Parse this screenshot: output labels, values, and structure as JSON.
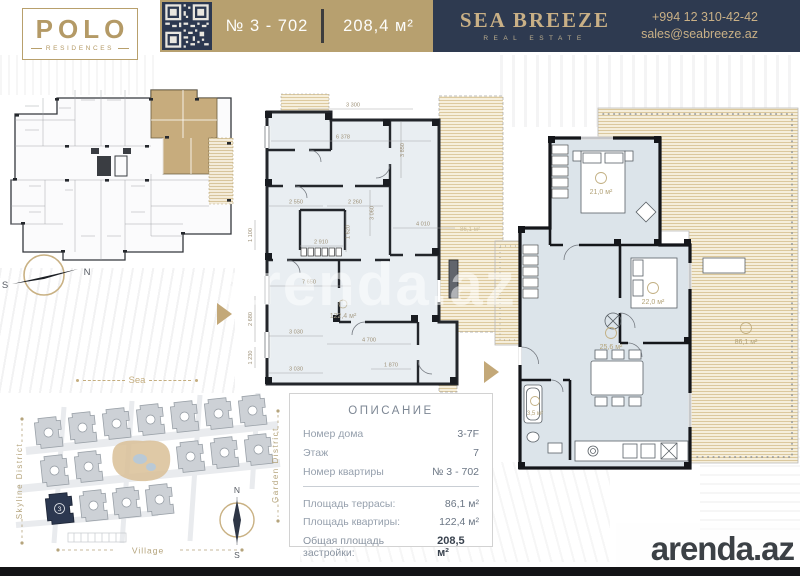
{
  "header": {
    "logo": {
      "title": "POLO",
      "subtitle": "RESIDENCES"
    },
    "apartment_number": "№ 3 - 702",
    "apartment_area": "208,4 м²",
    "agency": {
      "name": "SEA BREEZE",
      "tagline": "REAL ESTATE",
      "phone": "+994 12 310-42-42",
      "email": "sales@seabreeze.az"
    }
  },
  "colors": {
    "gold": "#b7a06f",
    "navy": "#2e3a50",
    "highlight_unit": "#c1a470",
    "plan_floor": "#dce4ea",
    "terrace": "#f5eedc"
  },
  "key_plan": {
    "compass": {
      "north": "N",
      "south": "S"
    },
    "sea_label": "Sea"
  },
  "middle_plan": {
    "dims": [
      "3 300",
      "6 378",
      "3 850",
      "2 550",
      "2 260",
      "3 060",
      "4 010",
      "1 620",
      "2 910",
      "1 100",
      "7 650",
      "2 680",
      "1 230",
      "3 030",
      "4 700",
      "3 030",
      "1 870"
    ],
    "apartment_area": "122,4 м²",
    "terrace_area": "86,1 м²"
  },
  "furnished_plan": {
    "rooms": [
      {
        "area": "21,0 м²"
      },
      {
        "area": "22,0 м²"
      },
      {
        "area": "25,6 м²"
      },
      {
        "area": "3,5 м²"
      },
      {
        "area": "86,1 м²"
      }
    ]
  },
  "site_map": {
    "district_left": "Skyline District",
    "district_right": "Garden District",
    "village_label": "Village",
    "highlighted_building": "3",
    "compass": {
      "north": "N",
      "south": "S"
    }
  },
  "description": {
    "title": "ОПИСАНИЕ",
    "rows": [
      {
        "label": "Номер дома",
        "value": "3-7F"
      },
      {
        "label": "Этаж",
        "value": "7"
      },
      {
        "label": "Номер квартиры",
        "value": "№ 3 - 702"
      }
    ],
    "area_rows": [
      {
        "label": "Площадь террасы:",
        "value": "86,1 м²"
      },
      {
        "label": "Площадь квартиры:",
        "value": "122,4 м²"
      },
      {
        "label": "Общая площадь застройки:",
        "value": "208,5 м²"
      }
    ]
  },
  "watermark": {
    "center": "arenda.az",
    "corner": "arenda.az"
  }
}
